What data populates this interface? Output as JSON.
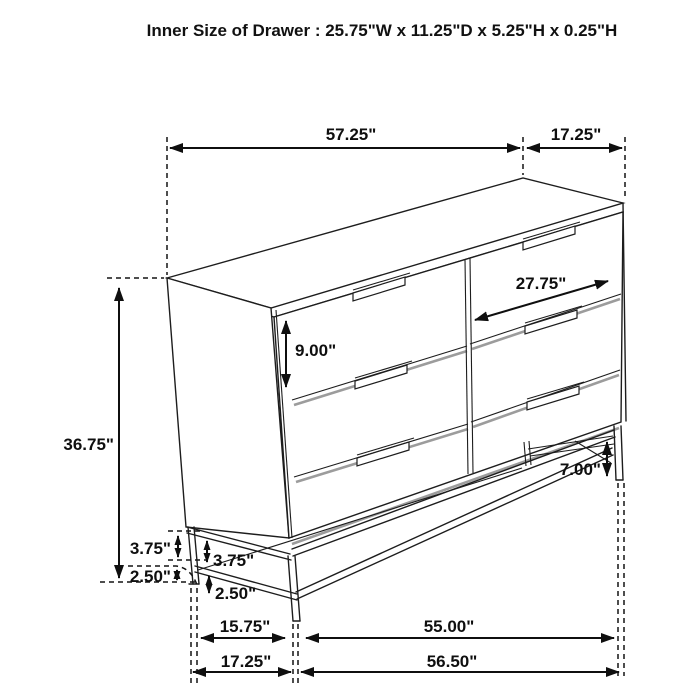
{
  "title": "Inner Size of Drawer : 25.75\"W x 11.25\"D x 5.25\"H x 0.25\"H",
  "diagram": {
    "type": "furniture-dimension-drawing",
    "subject": "six-drawer dresser on metal base frame",
    "line_color": "#1d1d1d",
    "shadow_color": "#9c9c9c",
    "labels": {
      "top_width": "57.25\"",
      "top_depth": "17.25\"",
      "drawer_width": "27.75\"",
      "drawer_height": "9.00\"",
      "overall_height": "36.75\"",
      "leg_height": "7.00\"",
      "base_upper_back": "3.75\"",
      "base_upper_front": "3.75\"",
      "base_lower_back": "2.50\"",
      "base_lower_front": "2.50\"",
      "leg_span_side": "15.75\"",
      "leg_span_front": "55.00\"",
      "outer_span_side": "17.25\"",
      "outer_span_front": "56.50\""
    }
  }
}
